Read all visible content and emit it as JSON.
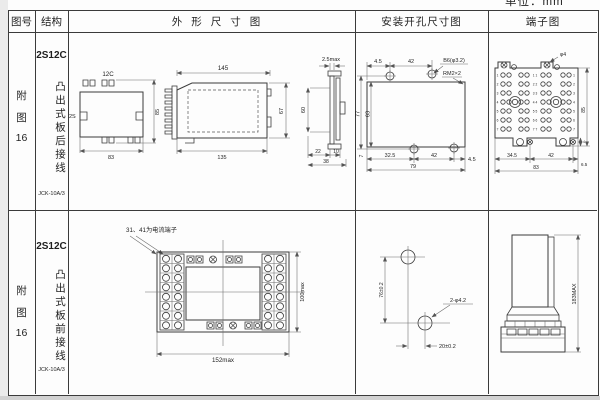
{
  "unit_label": "单位：mm",
  "headers": {
    "fig": "图号",
    "structure": "结构",
    "outline": "外形尺寸图",
    "mounting": "安装开孔尺寸图",
    "terminal": "端子图"
  },
  "rows": [
    {
      "fig_a": "附",
      "fig_b": "图",
      "fig_c": "16",
      "model": "2S12C",
      "structure_text": "凸出式板后接线",
      "type_code": "JCK-10A/3",
      "outline": {
        "front_top": "12C",
        "front_left": "2S",
        "front_h": "85",
        "front_w": "83",
        "side_top": "145",
        "side_bottom": "135",
        "edge_gap": "2.5max",
        "h_outer": "67",
        "h_inner": "60",
        "eb1": "22",
        "eb2": "10",
        "eb_total": "38"
      },
      "mounting": {
        "t1": "4.5",
        "t2": "42",
        "hole_label": "B6(φ3.2)",
        "thread_label": "RM2×2",
        "left_outer": "77",
        "left_inner": "63",
        "b0": "7",
        "b1": "32.5",
        "b2": "42",
        "b3": "4.5",
        "b_total": "79"
      },
      "terminal": {
        "top_hole": "φ4",
        "row_numbers": [
          "1",
          "2",
          "3",
          "4",
          "5",
          "6",
          "7"
        ],
        "mid_labels": [
          "1 1",
          "2 2",
          "3 3",
          "4 4",
          "5 5",
          "6 6",
          "7 7"
        ],
        "b1": "34.5",
        "b2": "42",
        "b3": "6.5",
        "b_total": "83",
        "right_h": "85",
        "tab_h": "4"
      }
    },
    {
      "fig_a": "附",
      "fig_b": "图",
      "fig_c": "16",
      "model": "2S12C",
      "structure_text": "凸出式板前接线",
      "type_code": "JCK-10A/3",
      "outline": {
        "note": "31、41为电流端子",
        "w": "152max",
        "h": "100max"
      },
      "mounting": {
        "v": "76±0.2",
        "hole_label": "2-φ4.2",
        "h": "20±0.2"
      },
      "terminal": {
        "h": "183MAX"
      }
    }
  ]
}
